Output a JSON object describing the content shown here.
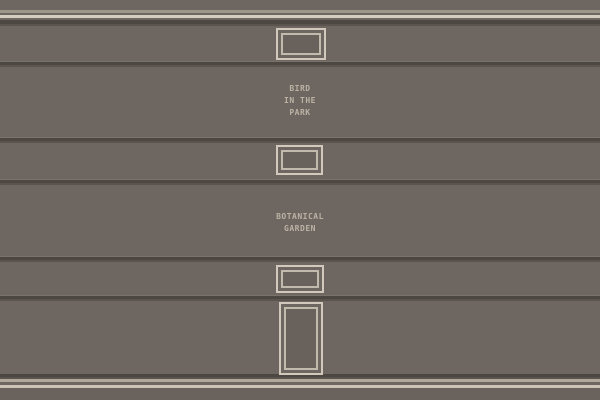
{
  "scene": {
    "name": "gallery wall",
    "plaques": [
      {
        "id": "bird-in-the-park",
        "lines": [
          "BIRD",
          "IN THE",
          "PARK"
        ]
      },
      {
        "id": "botanical-garden",
        "lines": [
          "BOTANICAL",
          "GARDEN"
        ]
      }
    ],
    "frames": [
      {
        "id": "small-frame-top"
      },
      {
        "id": "small-frame-middle"
      },
      {
        "id": "small-frame-lower"
      },
      {
        "id": "door-panel"
      }
    ]
  },
  "colors": {
    "wall": "#6d6661",
    "wall-bottom": "#69625d",
    "seam-highlight": "#7a736c",
    "seam-dark": "#4d4742",
    "seam-mid": "#5b544e",
    "stripe-dim": "#9e958b",
    "stripe-bright": "#d6cdc1",
    "baseboard-stripe-1": "#b1a79b",
    "baseboard-stripe-2": "#cdc3b6",
    "frame-border": "#d2c9bc",
    "frame-border-inner": "#c3baae",
    "frame-interior": "#68615c",
    "label-text": "#bdb3a5"
  }
}
